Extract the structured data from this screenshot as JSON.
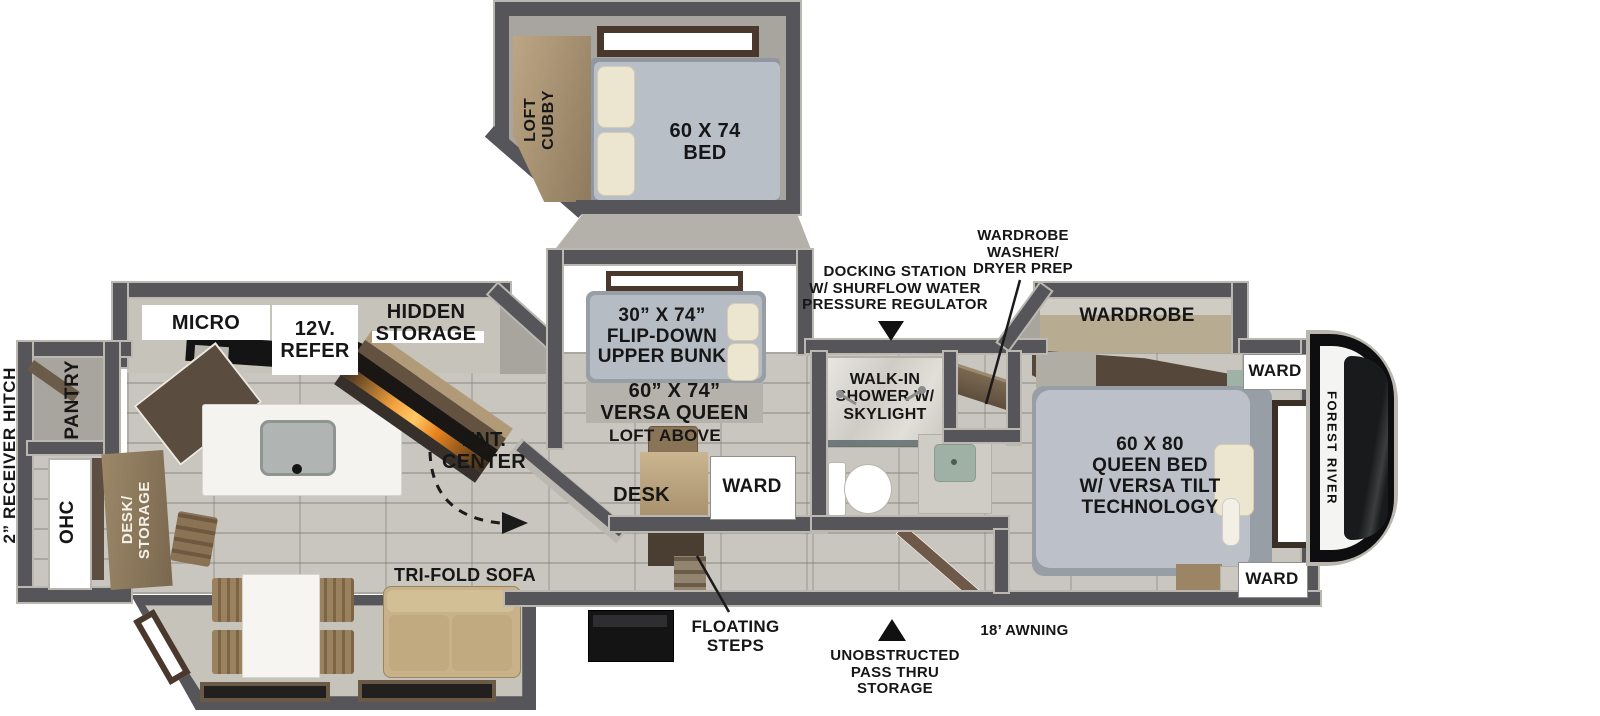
{
  "exterior": {
    "hitch": "2” RECEIVER HITCH",
    "docking_station": "DOCKING STATION\nW/ SHURFLOW WATER\nPRESSURE REGULATOR",
    "wd_prep": "WARDROBE\nWASHER/\nDRYER PREP",
    "floating_steps": "FLOATING\nSTEPS",
    "pass_thru": "UNOBSTRUCTED\nPASS THRU\nSTORAGE",
    "awning": "18’ AWNING",
    "brand": "FOREST RIVER"
  },
  "loft": {
    "cubby": "LOFT\nCUBBY",
    "bed": "60 X 74\nBED"
  },
  "bunk_room": {
    "upper_bunk": "30” X 74”\nFLIP-DOWN\nUPPER BUNK",
    "versa_queen": "60” X 74”\nVERSA QUEEN",
    "loft_above": "LOFT ABOVE",
    "desk": "DESK",
    "ward": "WARD"
  },
  "kitchen": {
    "micro": "MICRO",
    "refer": "12V.\nREFER",
    "hidden_storage": "HIDDEN\nSTORAGE",
    "pantry": "PANTRY",
    "ohc": "OHC",
    "desk_storage": "DESK/\nSTORAGE",
    "ent_center": "ENT.\nCENTER"
  },
  "living": {
    "sofa": "TRI-FOLD SOFA"
  },
  "bath": {
    "shower": "WALK-IN\nSHOWER W/\nSKYLIGHT"
  },
  "bedroom": {
    "wardrobe": "WARDROBE",
    "ward_top": "WARD",
    "ward_bottom": "WARD",
    "queen_bed": "60 X 80\nQUEEN BED\nW/ VERSA TILT\nTECHNOLOGY"
  },
  "colors": {
    "wall": "#55555a",
    "wall_skin": "#bab8b0",
    "floor_tile": "#c9c6bf",
    "slide_floor": "#c6c3ba",
    "interior_gray": "#a7a59e",
    "mattress": "#bcc1c9",
    "pillow": "#ece5d0",
    "wood_light": "#b39d7c",
    "wood_dark": "#5e5044",
    "sofa": "#c9b28a",
    "fireplace_glow": "#f2a13d",
    "label_text": "#161616"
  }
}
